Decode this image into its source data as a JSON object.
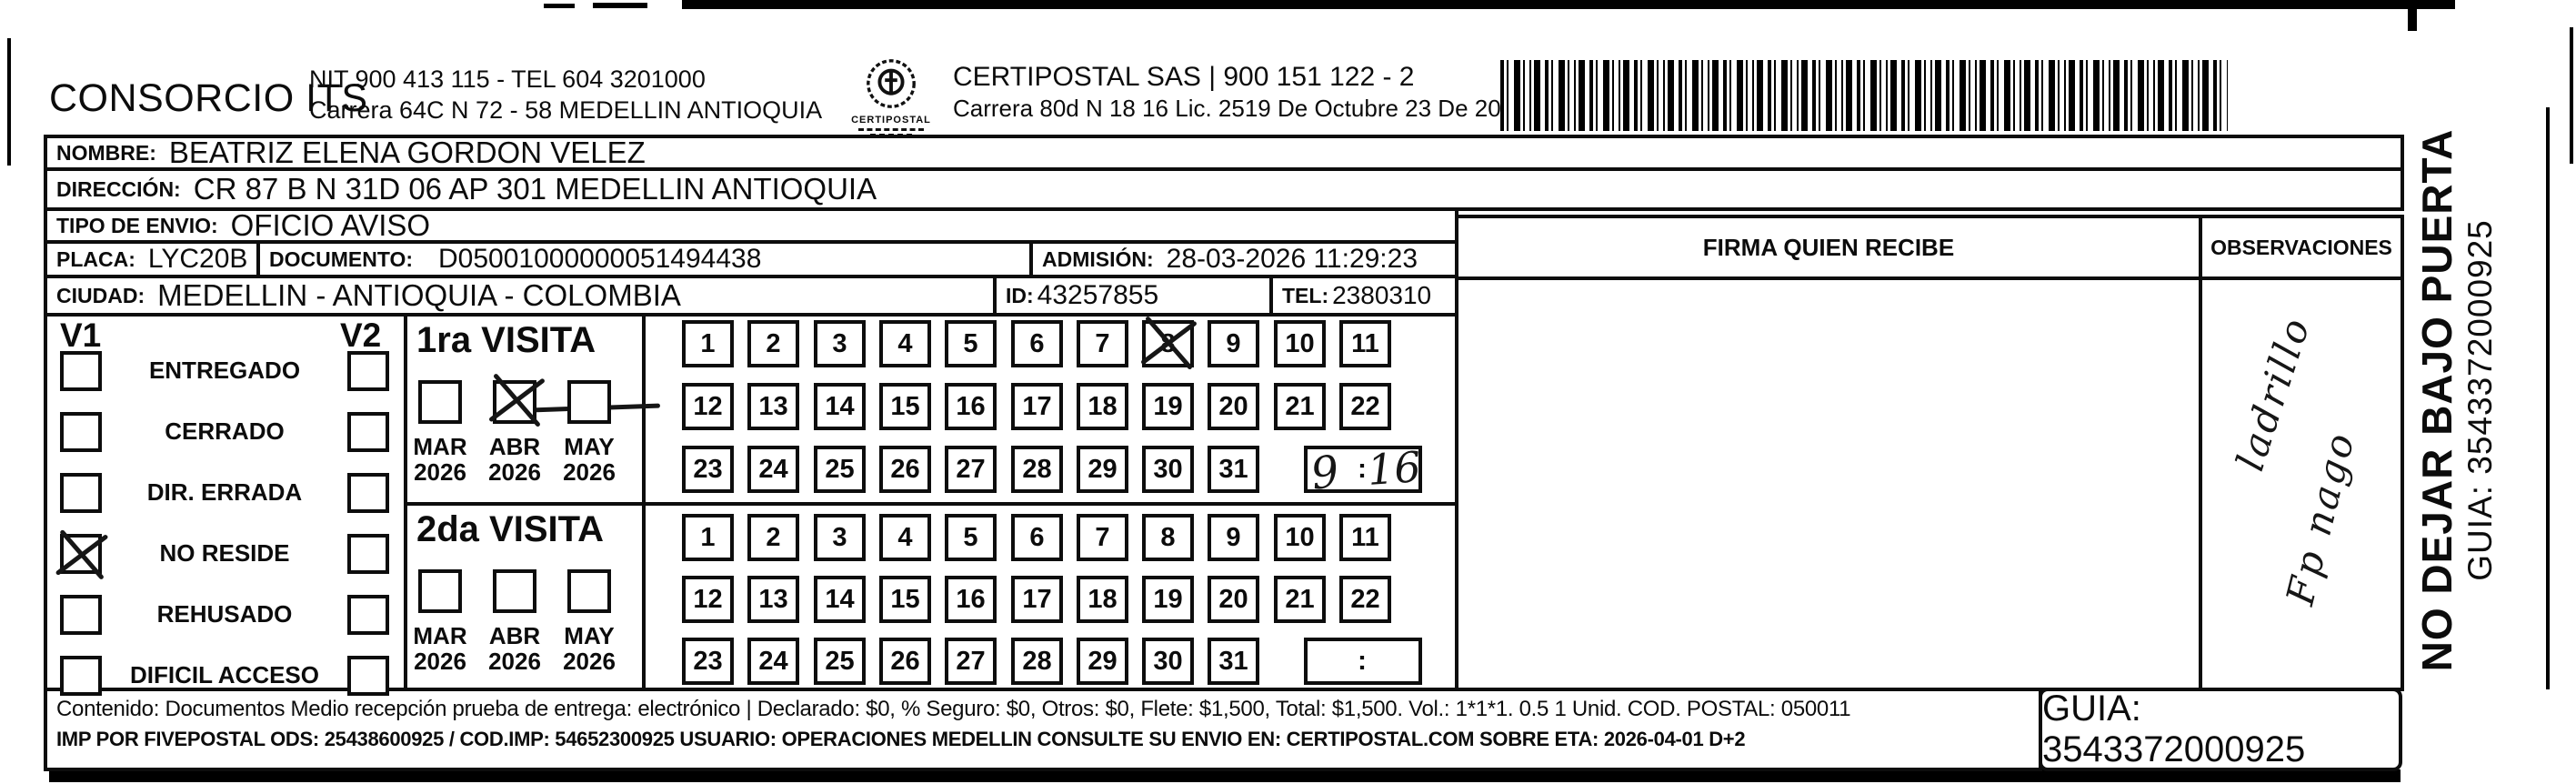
{
  "header": {
    "company": "CONSORCIO ITS",
    "nit_line": "NIT 900 413 115 - TEL 604 3201000",
    "company_address": "Carrera 64C N 72 - 58 MEDELLIN ANTIOQUIA",
    "logo_text": "CERTIPOSTAL",
    "certipostal_line": "CERTIPOSTAL SAS | 900 151 122 - 2",
    "certipostal_address": "Carrera 80d N 18 16  Lic. 2519 De Octubre 23 De 2015"
  },
  "recipient": {
    "nombre_label": "NOMBRE:",
    "nombre": "BEATRIZ ELENA GORDON VELEZ",
    "direccion_label": "DIRECCIÓN:",
    "direccion": "CR 87 B N 31D 06 AP 301 MEDELLIN ANTIOQUIA",
    "tipo_envio_label": "TIPO DE ENVIO:",
    "tipo_envio": "OFICIO AVISO",
    "placa_label": "PLACA:",
    "placa": "LYC20B",
    "documento_label": "DOCUMENTO:",
    "documento": "D05001000000051494438",
    "admision_label": "ADMISIÓN:",
    "admision": "28-03-2026 11:29:23",
    "ciudad_label": "CIUDAD:",
    "ciudad": "MEDELLIN - ANTIOQUIA - COLOMBIA",
    "id_label": "ID:",
    "id": "43257855",
    "tel_label": "TEL:",
    "tel": "2380310"
  },
  "status": {
    "v1_header": "V1",
    "v2_header": "V2",
    "options": [
      {
        "label": "ENTREGADO",
        "v1": false,
        "v2": false
      },
      {
        "label": "CERRADO",
        "v1": false,
        "v2": false
      },
      {
        "label": "DIR. ERRADA",
        "v1": false,
        "v2": false
      },
      {
        "label": "NO RESIDE",
        "v1": true,
        "v2": false
      },
      {
        "label": "REHUSADO",
        "v1": false,
        "v2": false
      },
      {
        "label": "DIFICIL ACCESO",
        "v1": false,
        "v2": false
      }
    ]
  },
  "visits": {
    "months": [
      "MAR",
      "ABR",
      "MAY"
    ],
    "year": "2026",
    "days": [
      1,
      2,
      3,
      4,
      5,
      6,
      7,
      8,
      9,
      10,
      11,
      12,
      13,
      14,
      15,
      16,
      17,
      18,
      19,
      20,
      21,
      22,
      23,
      24,
      25,
      26,
      27,
      28,
      29,
      30,
      31
    ],
    "colon": ":",
    "first": {
      "title": "1ra VISITA",
      "checked_month": "ABR",
      "marked_day": 8,
      "time_hour": "9",
      "time_minute": "16"
    },
    "second": {
      "title": "2da VISITA",
      "checked_month": null,
      "marked_day": null,
      "time_hour": null,
      "time_minute": null
    }
  },
  "firma": {
    "header": "FIRMA QUIEN RECIBE"
  },
  "observaciones": {
    "header": "OBSERVACIONES",
    "handwriting": [
      "ladrillo",
      "Fp nago"
    ]
  },
  "sidebar": {
    "line1": "NO DEJAR BAJO PUERTA",
    "line2": "GUIA: 3543372000925"
  },
  "footer": {
    "line1": "Contenido: Documentos Medio recepción prueba de entrega: electrónico | Declarado: $0, % Seguro: $0, Otros: $0, Flete: $1,500, Total: $1,500. Vol.: 1*1*1. 0.5  1 Unid. COD. POSTAL: 050011",
    "line2": "IMP POR FIVEPOSTAL ODS: 25438600925 / COD.IMP: 54652300925 USUARIO: OPERACIONES MEDELLIN CONSULTE SU ENVIO EN: CERTIPOSTAL.COM SOBRE ETA: 2026-04-01 D+2",
    "guia": "GUIA: 3543372000925"
  }
}
